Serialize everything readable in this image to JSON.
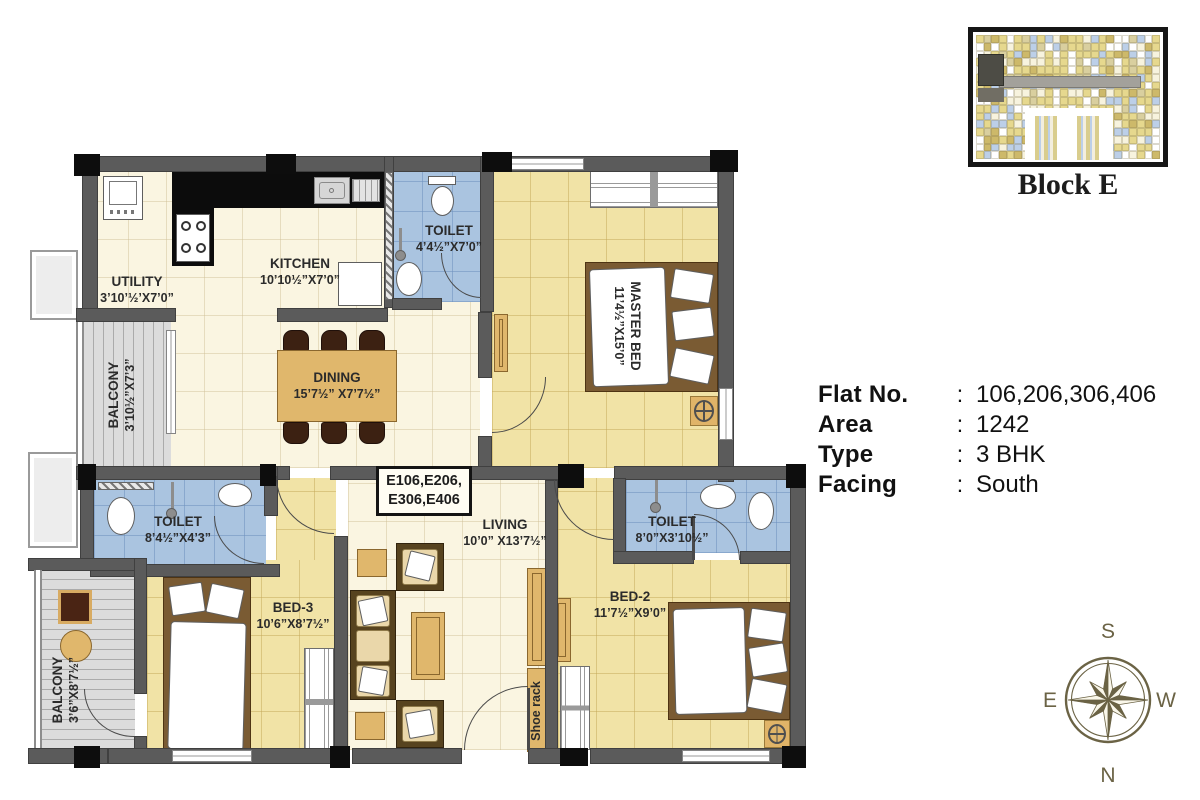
{
  "floorplan": {
    "unit_box": [
      "E106,E206,",
      "E306,E406"
    ],
    "shoe_rack": "Shoe rack",
    "rooms": [
      {
        "name": "UTILITY",
        "dims": "3’10’½’X7’0”"
      },
      {
        "name": "KITCHEN",
        "dims": "10’10½”X7’0”"
      },
      {
        "name": "TOILET",
        "dims": "4’4½”X7’0”"
      },
      {
        "name": "MASTER BED",
        "dims": "11’4½”X15’0”"
      },
      {
        "name": "BALCONY",
        "dims": "3’10½”X7’3”"
      },
      {
        "name": "DINING",
        "dims": "15’7½” X7’7½”"
      },
      {
        "name": "TOILET",
        "dims": "8’4½”X4’3”"
      },
      {
        "name": "BED-3",
        "dims": "10’6”X8’7½”"
      },
      {
        "name": "BALCONY",
        "dims": "3’6”X8’7½”"
      },
      {
        "name": "LIVING",
        "dims": "10’0” X13’7½”"
      },
      {
        "name": "BED-2",
        "dims": "11’7½”X9’0”"
      },
      {
        "name": "TOILET",
        "dims": "8’0”X3’10½”"
      }
    ]
  },
  "block": {
    "label": "Block E"
  },
  "info": {
    "rows": [
      {
        "label": "Flat No.",
        "sep": ":",
        "value": "106,206,306,406"
      },
      {
        "label": "Area",
        "sep": ":",
        "value": "1242"
      },
      {
        "label": "Type",
        "sep": ":",
        "value": "3 BHK"
      },
      {
        "label": "Facing",
        "sep": ":",
        "value": "South"
      }
    ]
  },
  "compass": {
    "top": "S",
    "left": "E",
    "right": "W",
    "bottom": "N"
  }
}
